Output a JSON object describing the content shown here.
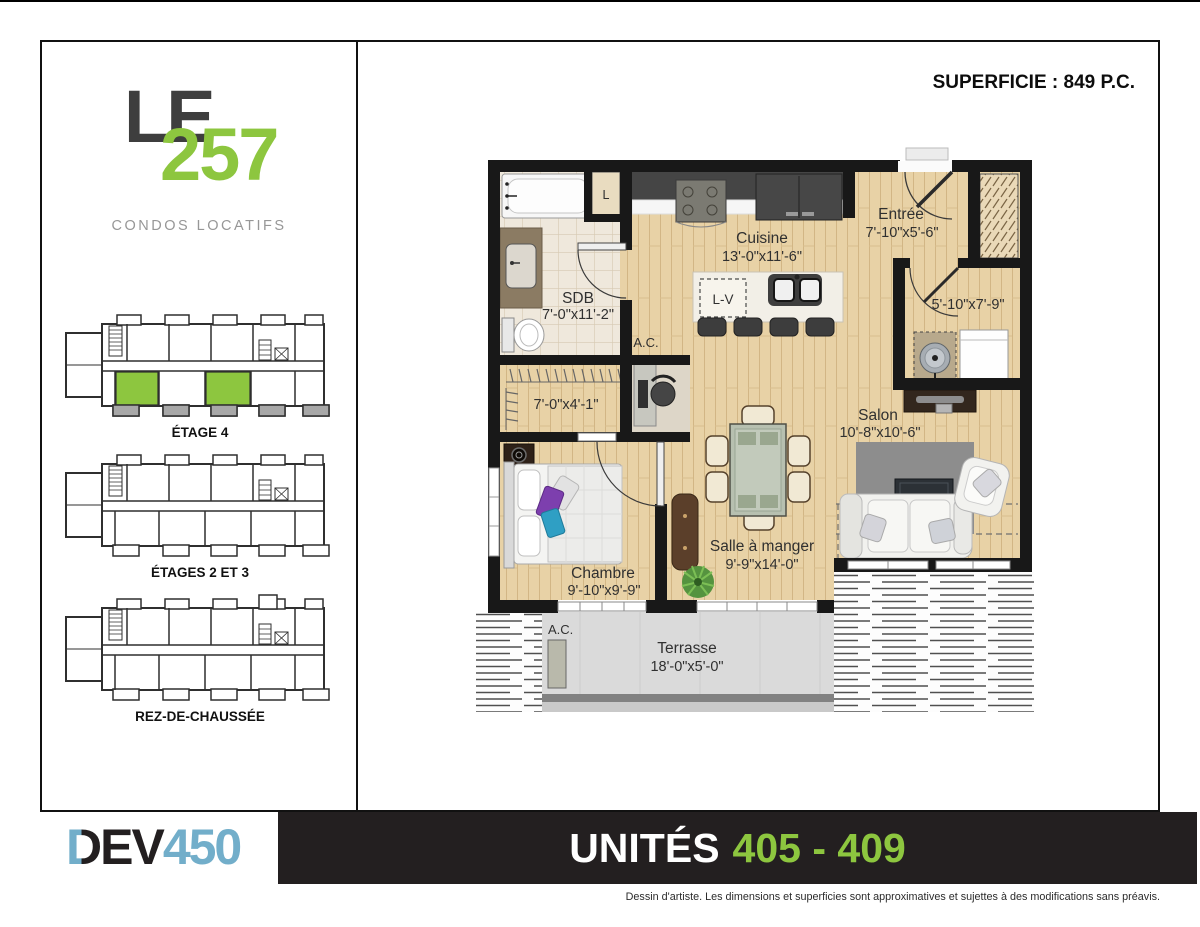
{
  "header": {
    "superficie_label": "SUPERFICIE : 849 P.C."
  },
  "sidebar": {
    "logo": {
      "line1": "LE",
      "number": "257",
      "tagline": "CONDOS LOCATIFS"
    },
    "floor_plans": [
      {
        "label": "ÉTAGE 4",
        "highlighted_units": 2
      },
      {
        "label": "ÉTAGES 2 ET 3",
        "highlighted_units": 0
      },
      {
        "label": "REZ-DE-CHAUSSÉE",
        "highlighted_units": 0
      }
    ]
  },
  "floorplan": {
    "rooms": {
      "sdb": {
        "name": "SDB",
        "dims": "7'-0\"x11'-2\""
      },
      "walkin": {
        "dims": "7'-0\"x4'-1\""
      },
      "chambre": {
        "name": "Chambre",
        "dims": "9'-10\"x9'-9\""
      },
      "cuisine": {
        "name": "Cuisine",
        "dims": "13'-0\"x11'-6\""
      },
      "entree": {
        "name": "Entrée",
        "dims": "7'-10\"x5'-6\""
      },
      "rangement": {
        "dims": "5'-10\"x7'-9\""
      },
      "salon": {
        "name": "Salon",
        "dims": "10'-8\"x10'-6\""
      },
      "salle_a_manger": {
        "name": "Salle à manger",
        "dims": "9'-9\"x14'-0\""
      },
      "terrasse": {
        "name": "Terrasse",
        "dims": "18'-0\"x5'-0\""
      }
    },
    "labels": {
      "laveuse": "L",
      "lave_vaisselle": "L-V",
      "ac": "A.C.",
      "ac_terrasse": "A.C."
    }
  },
  "footer": {
    "brand": {
      "d": "D",
      "ev": "EV",
      "num": "450"
    },
    "banner": {
      "label": "UNITÉS",
      "range": "405 - 409"
    },
    "disclaimer": "Dessin d'artiste. Les dimensions et superficies sont approximatives et sujettes à des modifications sans préavis."
  },
  "colors": {
    "accent_green": "#8dc63f",
    "brand_blue": "#72aeca",
    "banner_bg": "#231f20"
  }
}
